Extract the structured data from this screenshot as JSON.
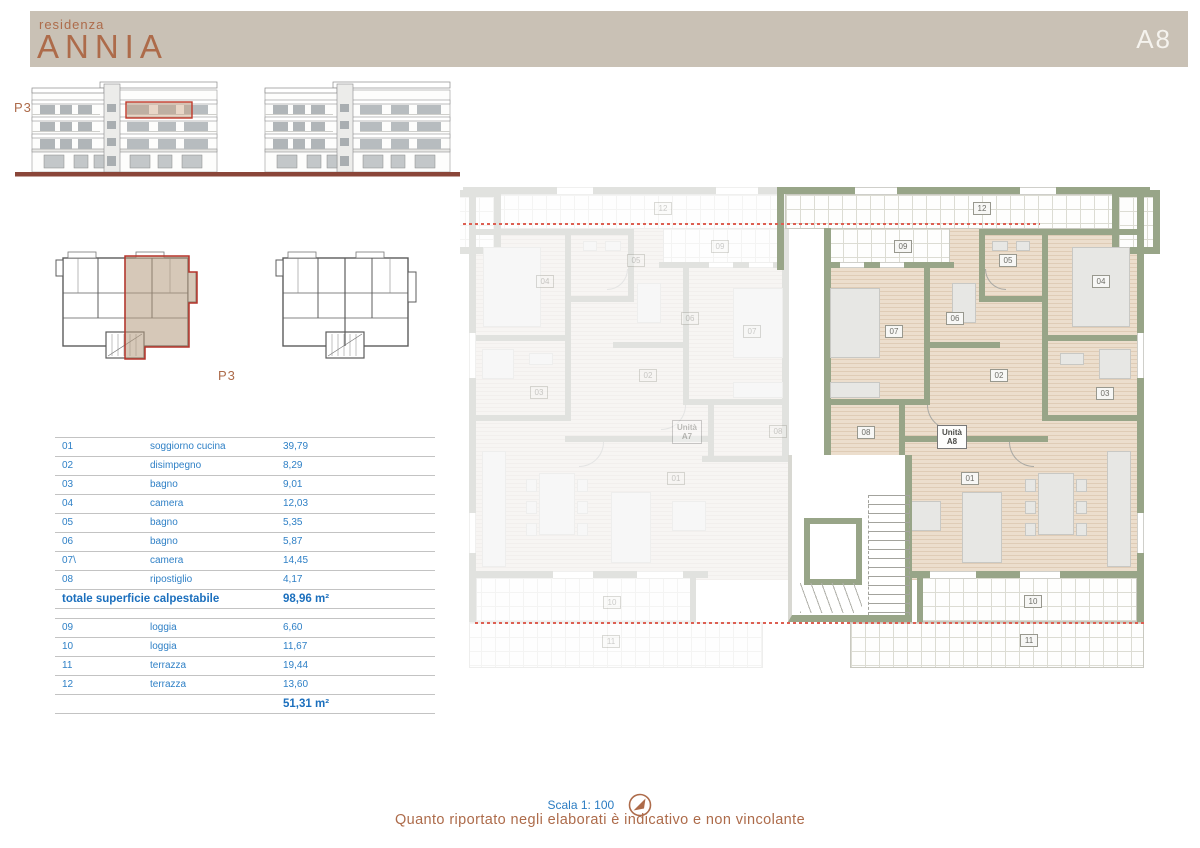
{
  "header": {
    "brand_top": "residenza",
    "brand_name": "ANNIA",
    "unit_badge": "A8"
  },
  "elevation": {
    "floor_label": "P3"
  },
  "keyplan": {
    "floor_label": "P3"
  },
  "tables": {
    "interior": {
      "rows": [
        {
          "num": "01",
          "name": "soggiorno cucina",
          "area": "39,79"
        },
        {
          "num": "02",
          "name": "disimpegno",
          "area": "8,29"
        },
        {
          "num": "03",
          "name": "bagno",
          "area": "9,01"
        },
        {
          "num": "04",
          "name": "camera",
          "area": "12,03"
        },
        {
          "num": "05",
          "name": "bagno",
          "area": "5,35"
        },
        {
          "num": "06",
          "name": "bagno",
          "area": "5,87"
        },
        {
          "num": "07\\",
          "name": "camera",
          "area": "14,45"
        },
        {
          "num": "08",
          "name": "ripostiglio",
          "area": "4,17"
        }
      ],
      "total_label": "totale superficie calpestabile",
      "total_area": "98,96 m²"
    },
    "exterior": {
      "rows": [
        {
          "num": "09",
          "name": "loggia",
          "area": "6,60"
        },
        {
          "num": "10",
          "name": "loggia",
          "area": "11,67"
        },
        {
          "num": "11",
          "name": "terrazza",
          "area": "19,44"
        },
        {
          "num": "12",
          "name": "terrazza",
          "area": "13,60"
        }
      ],
      "total_area": "51,31 m²"
    }
  },
  "plan": {
    "unit_a8": {
      "line1": "Unità",
      "line2": "A8"
    },
    "unit_a7": {
      "line1": "Unità",
      "line2": "A7"
    },
    "room_labels": [
      {
        "text": "12",
        "x": 513,
        "y": 19
      },
      {
        "text": "09",
        "x": 434,
        "y": 57
      },
      {
        "text": "05",
        "x": 539,
        "y": 71
      },
      {
        "text": "04",
        "x": 632,
        "y": 92
      },
      {
        "text": "06",
        "x": 486,
        "y": 129
      },
      {
        "text": "07",
        "x": 425,
        "y": 142
      },
      {
        "text": "02",
        "x": 530,
        "y": 186
      },
      {
        "text": "03",
        "x": 636,
        "y": 204
      },
      {
        "text": "08",
        "x": 397,
        "y": 243
      },
      {
        "text": "01",
        "x": 501,
        "y": 289
      },
      {
        "text": "10",
        "x": 564,
        "y": 412
      },
      {
        "text": "11",
        "x": 560,
        "y": 451
      },
      {
        "text": "12",
        "x": 194,
        "y": 19,
        "cls": "faint"
      },
      {
        "text": "09",
        "x": 251,
        "y": 57,
        "cls": "faint"
      },
      {
        "text": "05",
        "x": 167,
        "y": 71,
        "cls": "faint"
      },
      {
        "text": "04",
        "x": 76,
        "y": 92,
        "cls": "faint"
      },
      {
        "text": "06",
        "x": 221,
        "y": 129,
        "cls": "faint"
      },
      {
        "text": "07",
        "x": 283,
        "y": 142,
        "cls": "faint"
      },
      {
        "text": "02",
        "x": 179,
        "y": 186,
        "cls": "faint"
      },
      {
        "text": "03",
        "x": 70,
        "y": 203,
        "cls": "faint"
      },
      {
        "text": "08",
        "x": 309,
        "y": 242,
        "cls": "faint"
      },
      {
        "text": "01",
        "x": 207,
        "y": 289,
        "cls": "faint"
      },
      {
        "text": "10",
        "x": 143,
        "y": 413,
        "cls": "faint"
      },
      {
        "text": "11",
        "x": 142,
        "y": 452,
        "cls": "faint"
      }
    ]
  },
  "footer": {
    "scale_text": "Scala 1: 100",
    "disclaimer": "Quanto riportato negli elaborati è indicativo e non vincolante"
  },
  "colors": {
    "accent_terracotta": "#ad6b4a",
    "accent_blue": "#2b7cc2",
    "wall_green": "#98a588",
    "band_beige": "#c9c1b5",
    "ground_maroon": "#8a4639",
    "highlight_red": "#c0392b"
  }
}
